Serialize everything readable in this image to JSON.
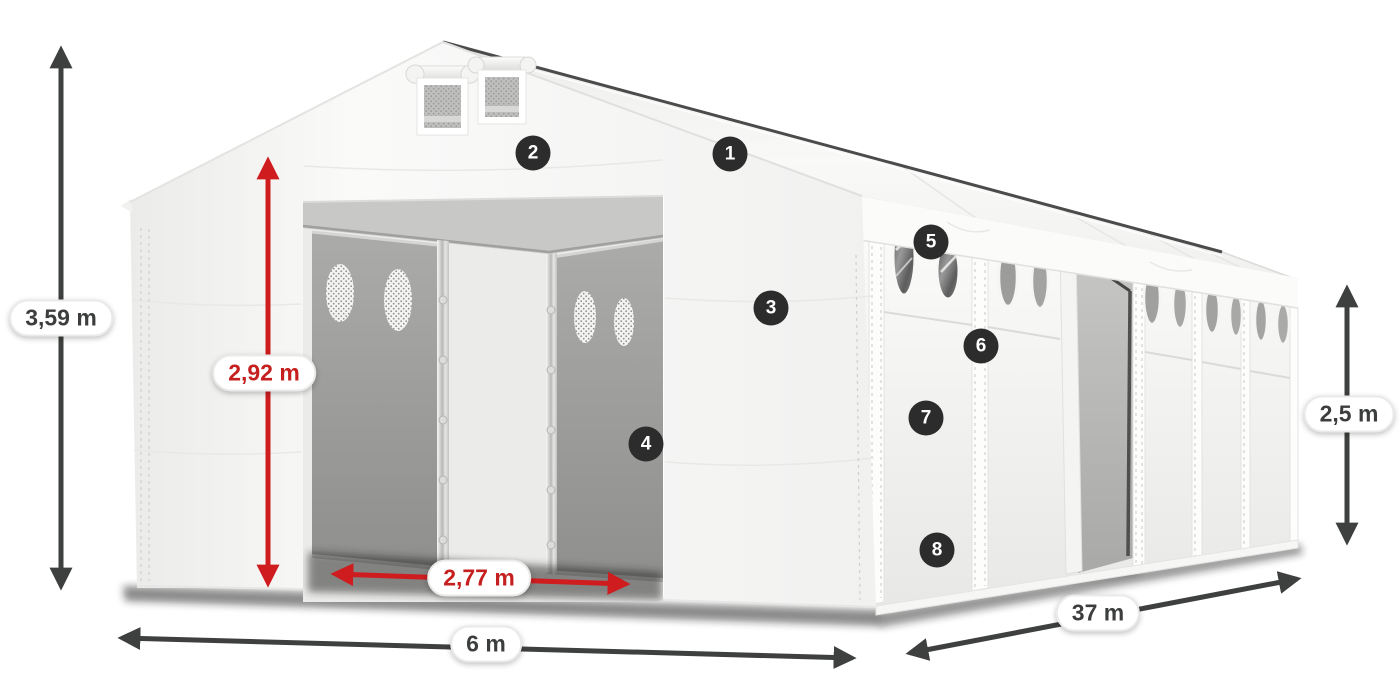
{
  "dimensions": {
    "total_height": "3,59 m",
    "entry_height": "2,92 m",
    "entry_width": "2,77 m",
    "width": "6 m",
    "length": "37 m",
    "side_height": "2,5 m"
  },
  "callouts": [
    "1",
    "2",
    "3",
    "4",
    "5",
    "6",
    "7",
    "8"
  ],
  "colors": {
    "accent_red": "#c5201f",
    "arrow_red": "#ce1c1f",
    "arrow_dark": "#3e403f",
    "badge_bg": "#2b2c2b",
    "pill_border": "#eceae8",
    "tent_white": "#f7f7f6",
    "interior_gray": "#9a9a98"
  }
}
